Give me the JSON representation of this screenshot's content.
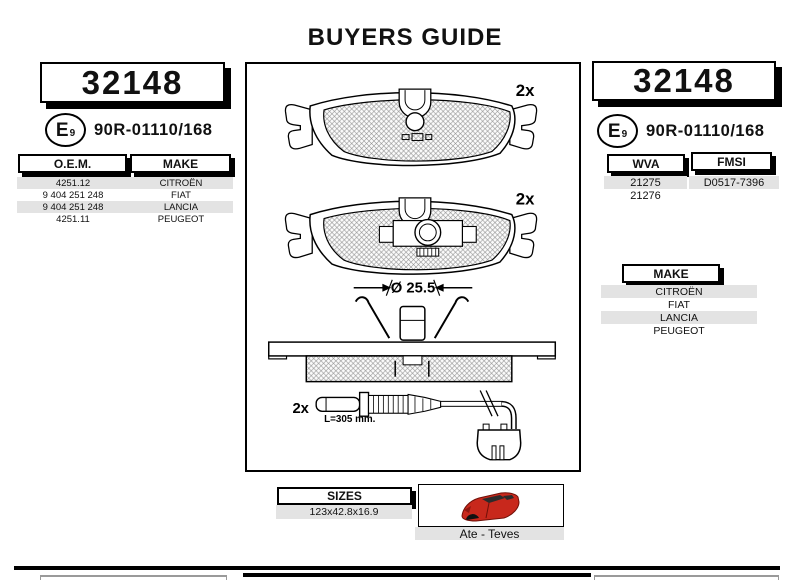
{
  "title": "BUYERS GUIDE",
  "part_number": "32148",
  "approval": {
    "e_letter": "E",
    "e_number": "9",
    "code": "90R-01110/168"
  },
  "left_panel": {
    "oem_header": "O.E.M.",
    "make_header": "MAKE",
    "rows": [
      {
        "oem": "4251.12",
        "make": "CITROËN"
      },
      {
        "oem": "9 404 251 248",
        "make": "FIAT"
      },
      {
        "oem": "9 404 251 248",
        "make": "LANCIA"
      },
      {
        "oem": "4251.11",
        "make": "PEUGEOT"
      }
    ]
  },
  "right_panel": {
    "wva_header": "WVA",
    "wva_rows": [
      "21275",
      "21276"
    ],
    "fmsi_header": "FMSI",
    "fmsi_rows": [
      "D0517-7396"
    ],
    "make_header": "MAKE",
    "make_rows": [
      "CITROËN",
      "FIAT",
      "LANCIA",
      "PEUGEOT"
    ]
  },
  "diagram": {
    "pad_top_qty": "2x",
    "pad_bottom_qty": "2x",
    "piston_diameter": "Ø 25.5",
    "sensor_qty": "2x",
    "sensor_length": "L=305 mm."
  },
  "footer": {
    "sizes_header": "SIZES",
    "sizes_value": "123x42.8x16.9",
    "system_label": "Ate - Teves",
    "car_icon": "red-car-side"
  },
  "colors": {
    "row_alt": "#e3e3e3",
    "car_red": "#c8281c",
    "shadow": "#000000"
  }
}
